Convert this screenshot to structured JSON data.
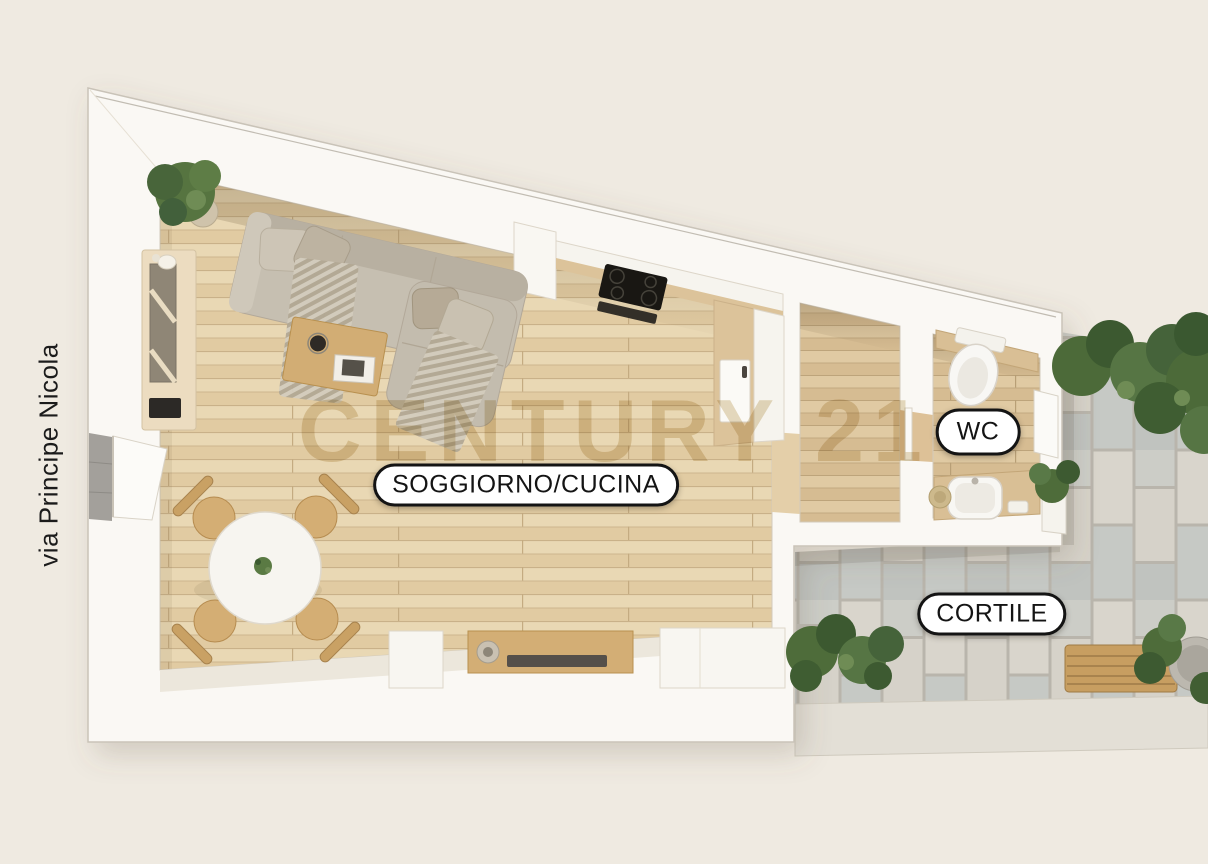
{
  "scene": {
    "street_label": "via Principe Nicola",
    "watermark": "CENTURY 21",
    "labels": {
      "living": "SOGGIORNO/CUCINA",
      "wc": "WC",
      "courtyard": "CORTILE"
    },
    "colors": {
      "background": "#efeae1",
      "wall": "#faf8f4",
      "wood_floor": "#e7d4ae",
      "wood_floor_dark": "#ddc59c",
      "paver_light": "#d9d5cc",
      "paver_grey": "#c2c5c1",
      "curb": "#e3dfd6",
      "furniture_wood": "#d2ad74",
      "sofa_grey": "#c6bfb1",
      "plant_green": "#4e6c3a",
      "accent_black": "#141414",
      "pill_bg": "#ffffff",
      "watermark_gold": "rgba(193,162,97,.42)"
    }
  }
}
